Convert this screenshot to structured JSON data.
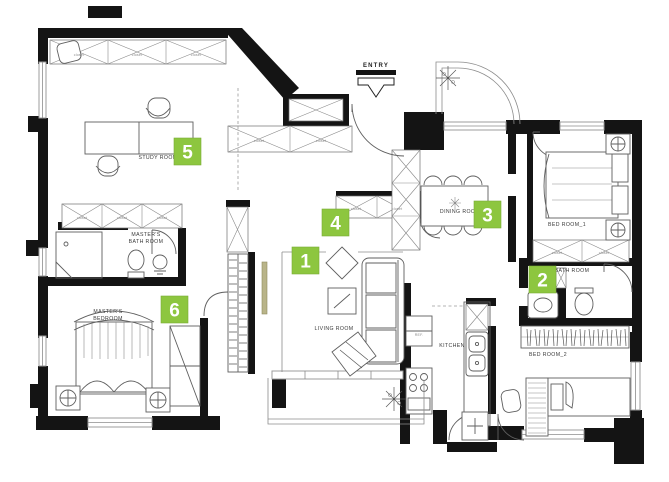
{
  "colors": {
    "marker_green": "#8dc63f",
    "wall_black": "#141414",
    "accent_olive": "#b9b489"
  },
  "entry": {
    "label": "ENTRY"
  },
  "markers": [
    {
      "num": "1"
    },
    {
      "num": "2"
    },
    {
      "num": "3"
    },
    {
      "num": "4"
    },
    {
      "num": "5"
    },
    {
      "num": "6"
    }
  ],
  "labels": {
    "study": "STUDY ROOM",
    "masters_bath_1": "MASTER'S",
    "masters_bath_2": "BATH ROOM",
    "masters_bed_1": "MASTER'S",
    "masters_bed_2": "BEDROOM",
    "living": "LIVING ROOM",
    "dining": "DINING ROOM",
    "bedroom1": "BED ROOM_1",
    "bath": "BATH ROOM",
    "bedroom2": "BED ROOM_2",
    "kitchen": "KITCHEN",
    "ref": "REF.",
    "closet": "closet"
  }
}
